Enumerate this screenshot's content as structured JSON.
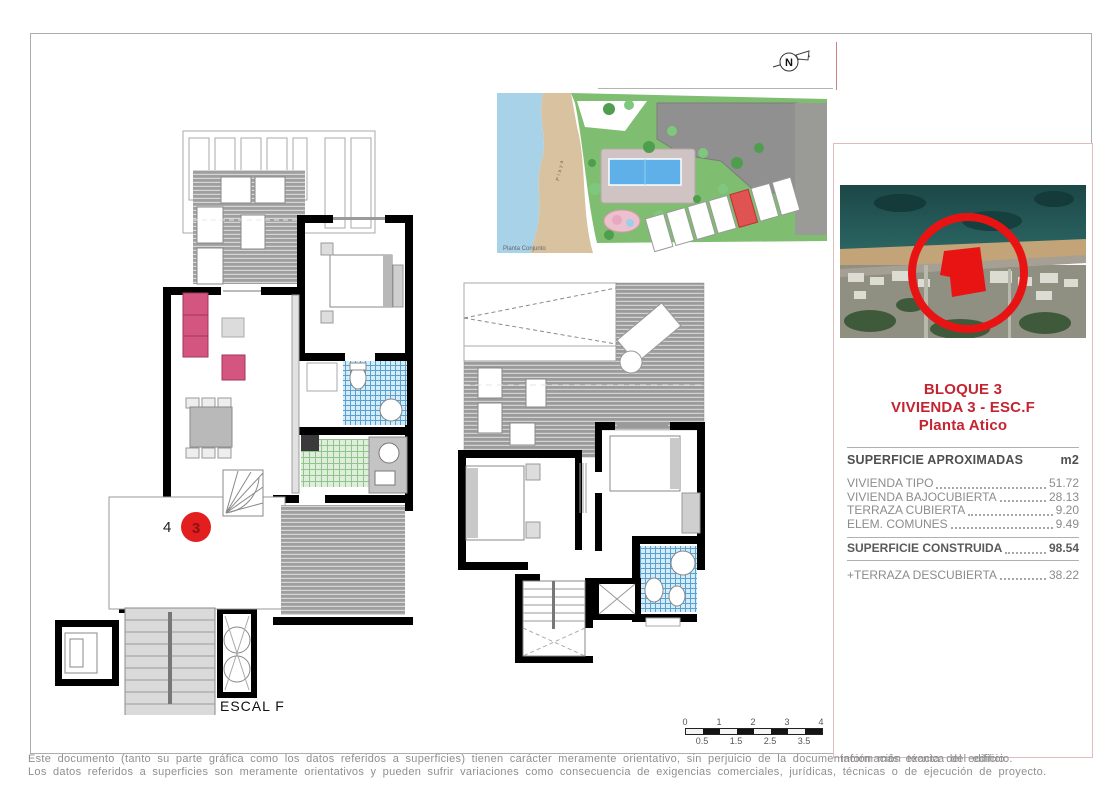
{
  "labels": {
    "unit_number": "4",
    "unit_marker": "3",
    "stair": "ESCAL F",
    "site_caption": "Planta Conjunto",
    "beach": "Playa",
    "north": "N"
  },
  "scale_bar": {
    "top_ticks": [
      "0",
      "1",
      "2",
      "3",
      "4"
    ],
    "bottom_ticks": [
      "0.5",
      "1.5",
      "2.5",
      "3.5"
    ]
  },
  "info_panel": {
    "title_lines": [
      "BLOQUE 3",
      "VIVIENDA 3 - ESC.F",
      "Planta Atico"
    ],
    "table": {
      "header": "SUPERFICIE APROXIMADAS",
      "unit": "m2",
      "rows": [
        {
          "label": "VIVIENDA TIPO",
          "value": "51.72"
        },
        {
          "label": "VIVIENDA BAJOCUBIERTA",
          "value": "28.13"
        },
        {
          "label": "TERRAZA CUBIERTA",
          "value": "9.20"
        },
        {
          "label": "ELEM. COMUNES",
          "value": "9.49"
        }
      ],
      "total": {
        "label": "SUPERFICIE CONSTRUIDA",
        "value": "98.54"
      },
      "extra": {
        "label": "+TERRAZA DESCUBIERTA",
        "value": "38.22"
      }
    }
  },
  "disclaimer": {
    "line1": "Este documento (tanto su parte gráfica como los datos referidos a superficies) tienen carácter meramente orientativo, sin perjuicio de la documentación más exacta del edificio.",
    "line1_overlay": "información técnica del edificio.",
    "line2": "Los datos referidos a superficies son meramente orientativos y pueden sufrir variaciones como consecuencia de exigencias comerciales, jurídicas, técnicas o de ejecución de proyecto."
  },
  "colors": {
    "accent_red": "#c42430",
    "marker_red": "#e31e1e",
    "site_highlight_red": "#e05353",
    "wall_black": "#000000",
    "terrace_gray": "#9f9f9f",
    "bath_tile_blue": "#57a0cf",
    "kitchen_tile_green": "#8fc48b",
    "sofa_pink": "#d4557f",
    "table_text_gray": "#8c8c8c"
  }
}
